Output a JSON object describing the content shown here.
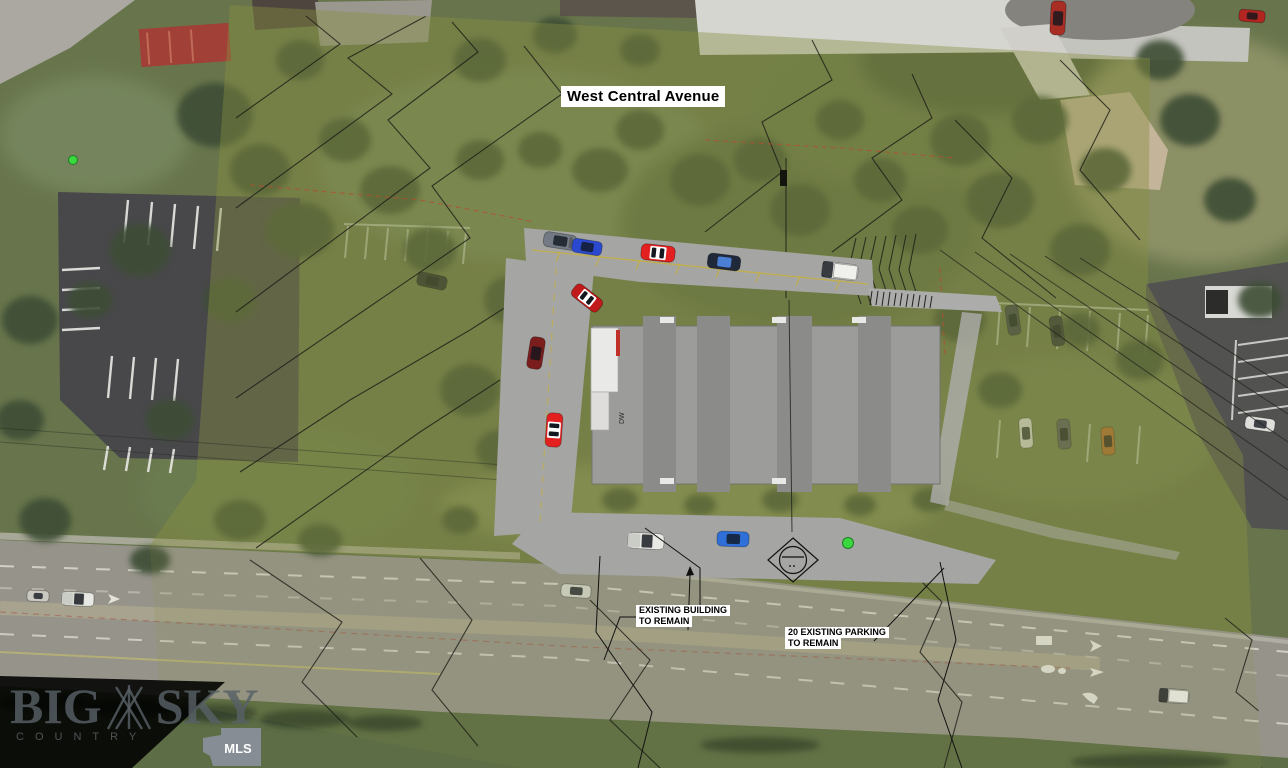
{
  "labels": {
    "street": "West Central Avenue",
    "building_interior": "DW"
  },
  "annotations": {
    "building": {
      "line1": "EXISTING BUILDING",
      "line2": "TO REMAIN"
    },
    "parking": {
      "line1": "20 EXISTING PARKING",
      "line2": "TO REMAIN"
    }
  },
  "watermark": {
    "big": "BIG",
    "sky": "SKY",
    "country": "COUNTRY",
    "mls": "MLS"
  },
  "palette": {
    "overlay_olive": "#879040",
    "plan_pavement": "#a5a5a3",
    "building_gray": "#9c9c9a",
    "building_band": "#8b8b89",
    "road_gray": "#96948a",
    "asphalt_dark": "#48484a",
    "marker_green": "#38d83e",
    "contour_black": "#1c1c17",
    "contour_red_dash": "#b1502f",
    "stripe_yellow": "#c9b23a"
  },
  "cars": [
    {
      "name": "suv-gray",
      "kind": "suv",
      "color": "#747a85",
      "x": 560,
      "y": 241,
      "rot": 9,
      "len": 33,
      "w": 15,
      "layer": "plan"
    },
    {
      "name": "car-blue",
      "kind": "sedan",
      "color": "#2b49cf",
      "x": 587,
      "y": 247,
      "rot": 9,
      "len": 30,
      "w": 14,
      "layer": "plan"
    },
    {
      "name": "car-red-striped",
      "kind": "striped",
      "color": "#e31f1f",
      "x": 658,
      "y": 253,
      "rot": 6,
      "len": 34,
      "w": 16,
      "layer": "plan"
    },
    {
      "name": "car-navy",
      "kind": "sedan",
      "color": "#20293a",
      "glass": "#4a7fd4",
      "x": 724,
      "y": 262,
      "rot": 7,
      "len": 33,
      "w": 15,
      "layer": "plan"
    },
    {
      "name": "truck-white",
      "kind": "truck",
      "color": "#e9e9e5",
      "x": 840,
      "y": 271,
      "rot": 7,
      "len": 36,
      "w": 16,
      "layer": "plan"
    },
    {
      "name": "car-red-diagonal",
      "kind": "striped",
      "color": "#c01a1a",
      "x": 587,
      "y": 298,
      "rot": 38,
      "len": 33,
      "w": 15,
      "layer": "plan"
    },
    {
      "name": "car-maroon",
      "kind": "sedan",
      "color": "#7c1d1d",
      "x": 536,
      "y": 353,
      "rot": 99,
      "len": 32,
      "w": 15,
      "layer": "plan"
    },
    {
      "name": "car-red-vertical",
      "kind": "striped",
      "color": "#e31f1f",
      "x": 554,
      "y": 430,
      "rot": 94,
      "len": 34,
      "w": 16,
      "layer": "plan"
    },
    {
      "name": "pickup-white",
      "kind": "pickup",
      "color": "#ebebe7",
      "x": 646,
      "y": 541,
      "rot": 3,
      "len": 36,
      "w": 16,
      "layer": "plan"
    },
    {
      "name": "car-blue-2",
      "kind": "sedan",
      "color": "#2f6fd8",
      "x": 733,
      "y": 539,
      "rot": 2,
      "len": 32,
      "w": 15,
      "layer": "plan"
    },
    {
      "name": "aerial-car-dark",
      "kind": "sedan",
      "color": "#23282e",
      "x": 432,
      "y": 281,
      "rot": 12,
      "len": 30,
      "w": 14,
      "layer": "photo"
    },
    {
      "name": "aerial-car-1",
      "kind": "sedan",
      "color": "#3a4047",
      "x": 1013,
      "y": 320,
      "rot": 82,
      "len": 30,
      "w": 13,
      "layer": "photo"
    },
    {
      "name": "aerial-car-2",
      "kind": "sedan",
      "color": "#2e3237",
      "x": 1057,
      "y": 331,
      "rot": 82,
      "len": 30,
      "w": 13,
      "layer": "photo"
    },
    {
      "name": "aerial-car-3",
      "kind": "sedan",
      "color": "#d9d9d5",
      "x": 1026,
      "y": 433,
      "rot": 86,
      "len": 30,
      "w": 13,
      "layer": "photo"
    },
    {
      "name": "aerial-car-4",
      "kind": "sedan",
      "color": "#56595d",
      "x": 1064,
      "y": 434,
      "rot": 86,
      "len": 30,
      "w": 13,
      "layer": "photo"
    },
    {
      "name": "aerial-car-orange",
      "kind": "sedan",
      "color": "#b06a30",
      "x": 1108,
      "y": 441,
      "rot": 86,
      "len": 28,
      "w": 13,
      "layer": "photo"
    },
    {
      "name": "aerial-car-white",
      "kind": "sedan",
      "color": "#dededa",
      "x": 1260,
      "y": 424,
      "rot": 8,
      "len": 30,
      "w": 13,
      "layer": "photo"
    },
    {
      "name": "aerial-truck-red",
      "kind": "sedan",
      "color": "#a82e24",
      "x": 1058,
      "y": 18,
      "rot": 93,
      "len": 34,
      "w": 15,
      "layer": "photo"
    },
    {
      "name": "aerial-car-red",
      "kind": "sedan",
      "color": "#b22520",
      "x": 1252,
      "y": 16,
      "rot": 5,
      "len": 26,
      "w": 12,
      "layer": "photo"
    },
    {
      "name": "road-car-1",
      "kind": "sedan",
      "color": "#d3d4cc",
      "x": 576,
      "y": 591,
      "rot": 4,
      "len": 30,
      "w": 13,
      "layer": "photo"
    },
    {
      "name": "road-truck",
      "kind": "pickup",
      "color": "#dcdcd6",
      "x": 78,
      "y": 599,
      "rot": 3,
      "len": 32,
      "w": 14,
      "layer": "photo"
    },
    {
      "name": "road-van",
      "kind": "van",
      "color": "#bcbdb5",
      "x": 1174,
      "y": 696,
      "rot": 4,
      "len": 30,
      "w": 14,
      "layer": "photo"
    },
    {
      "name": "road-car-2",
      "kind": "sedan",
      "color": "#c9c9c1",
      "x": 38,
      "y": 596,
      "rot": 3,
      "len": 22,
      "w": 11,
      "layer": "photo"
    }
  ]
}
